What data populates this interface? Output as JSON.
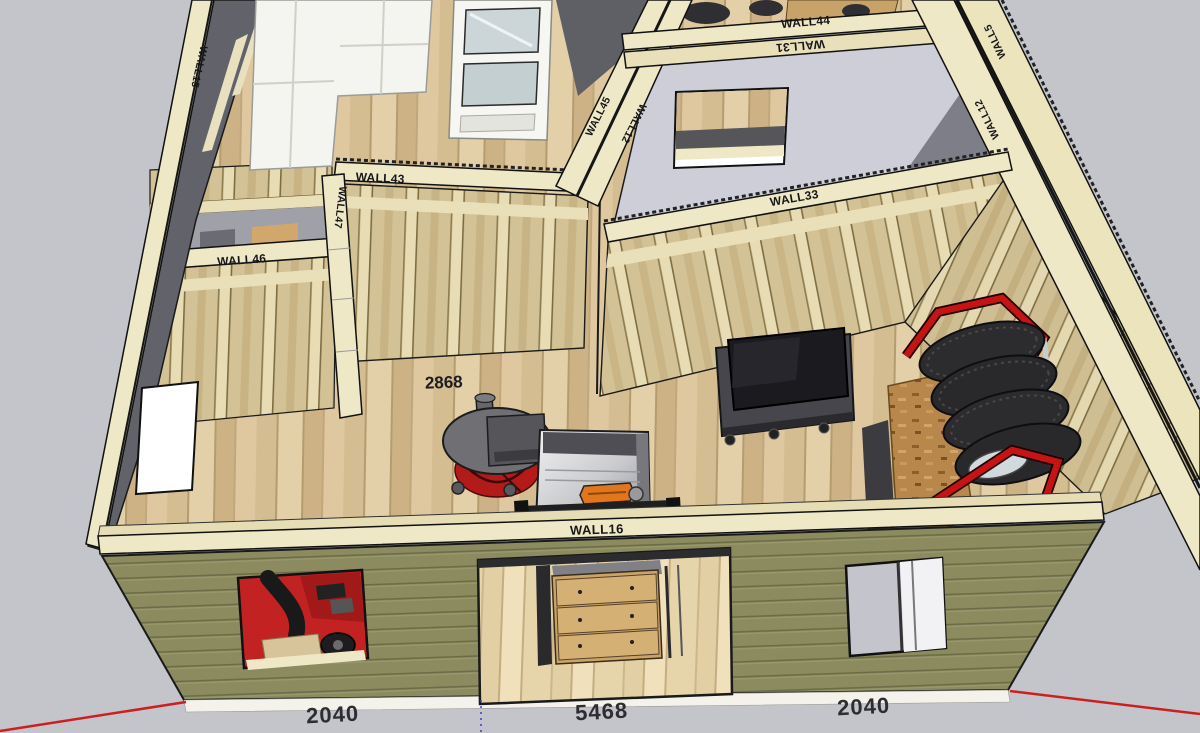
{
  "scene": {
    "background_color": "#c3c5cb",
    "siding_color": "#8b8b5f",
    "plate_color": "#efe8c6",
    "osb_color": "#d3c295",
    "floor_color": "#dcc79e",
    "accent_red": "#c41414"
  },
  "wall_labels": {
    "wall15": "WALL15",
    "wall43": "WALL43",
    "wall46": "WALL46",
    "wall47": "WALL47",
    "wall45": "WALL45",
    "wall12_upper": "WALL12",
    "wall44": "WALL44",
    "wall31": "WALL31",
    "wall5": "WALL5",
    "wall12_right": "WALL12",
    "wall33": "WALL33",
    "wall16": "WALL16"
  },
  "dimensions": {
    "floor_label": "2868",
    "front_left": "2040",
    "front_center": "5468",
    "front_right": "2040"
  }
}
